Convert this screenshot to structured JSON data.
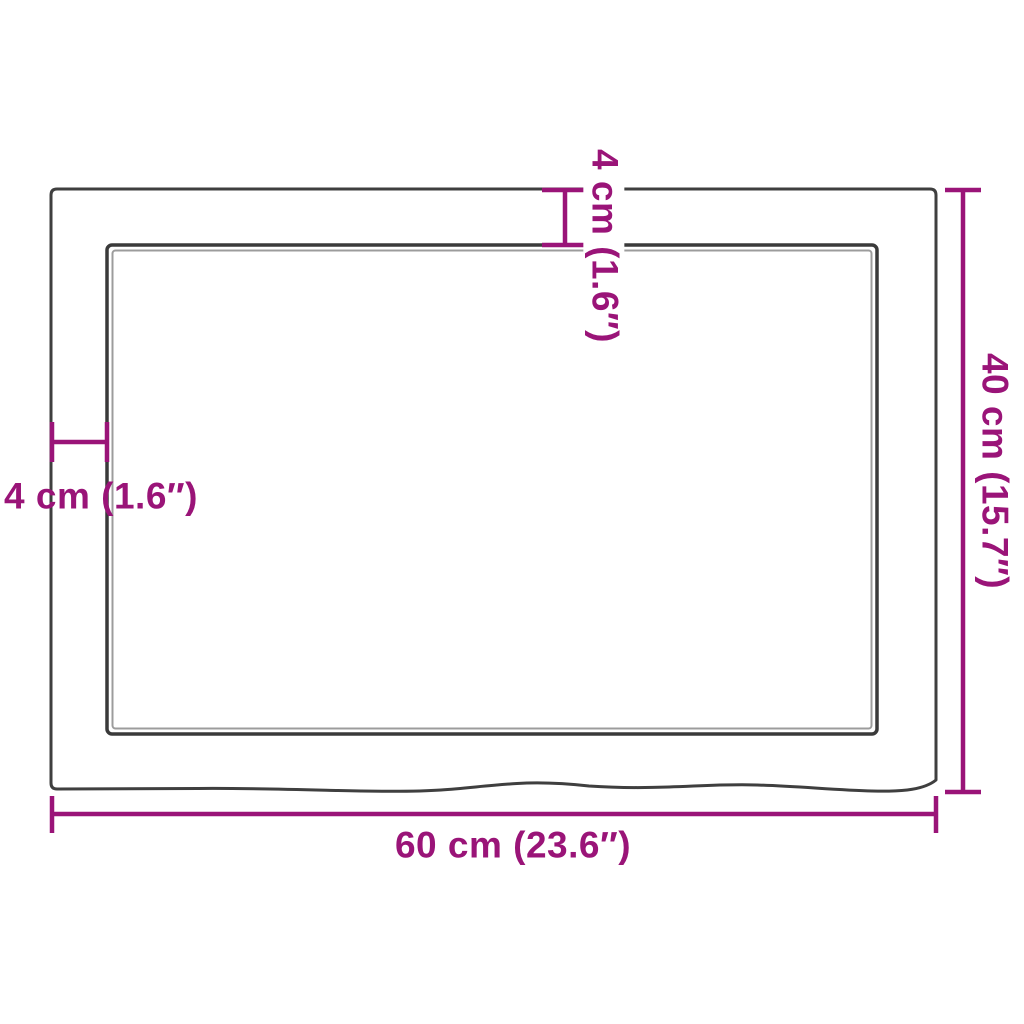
{
  "diagram": {
    "kind": "product dimension drawing",
    "colors": {
      "dimension_accent": "#9A1478",
      "outline_dark": "#3A3A3A",
      "outline_secondary": "#9C9C9C",
      "background": "#FFFFFF"
    },
    "dimensions": {
      "width": {
        "label": "60 cm (23.6″)",
        "value_cm": 60,
        "value_in": 23.6,
        "placement": "bottom-horizontal"
      },
      "height": {
        "label": "40 cm (15.7″)",
        "value_cm": 40,
        "value_in": 15.7,
        "placement": "right-vertical-rotated"
      },
      "top_edge_thickness": {
        "label": "4 cm (1.6″)",
        "value_cm": 4,
        "value_in": 1.6,
        "placement": "top-vertical-rotated"
      },
      "left_edge_thickness": {
        "label": "4 cm (1.6″)",
        "value_cm": 4,
        "value_in": 1.6,
        "placement": "left-horizontal"
      }
    }
  }
}
